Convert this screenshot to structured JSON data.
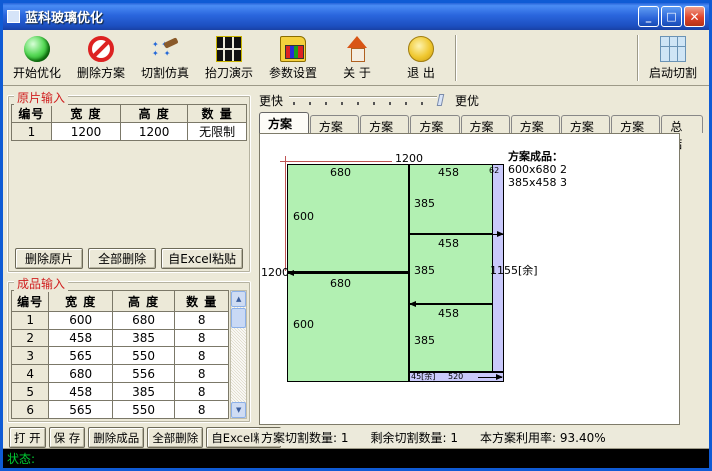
{
  "window": {
    "title": "蓝科玻璃优化",
    "minimize": "_",
    "maximize": "□",
    "close": "✕"
  },
  "toolbar": {
    "buttons": [
      {
        "label": "开始优化",
        "icon": "optimize"
      },
      {
        "label": "删除方案",
        "icon": "delete-plan"
      },
      {
        "label": "切割仿真",
        "icon": "simulate"
      },
      {
        "label": "抬刀演示",
        "icon": "knife-demo"
      },
      {
        "label": "参数设置",
        "icon": "settings"
      },
      {
        "label": "关 于",
        "icon": "about"
      },
      {
        "label": "退 出",
        "icon": "exit"
      }
    ],
    "start_cut": {
      "label": "启动切割",
      "icon": "start-cut"
    }
  },
  "sheet_input": {
    "title": "原片输入",
    "headers": [
      "编号",
      "宽 度",
      "高 度",
      "数 量"
    ],
    "rows": [
      [
        "1",
        "1200",
        "1200",
        "无限制"
      ]
    ],
    "buttons": [
      "删除原片",
      "全部删除",
      "自Excel粘贴"
    ]
  },
  "product_input": {
    "title": "成品输入",
    "headers": [
      "编号",
      "宽 度",
      "高 度",
      "数 量"
    ],
    "rows": [
      [
        "1",
        "600",
        "680",
        "8"
      ],
      [
        "2",
        "458",
        "385",
        "8"
      ],
      [
        "3",
        "565",
        "550",
        "8"
      ],
      [
        "4",
        "680",
        "556",
        "8"
      ],
      [
        "5",
        "458",
        "385",
        "8"
      ],
      [
        "6",
        "565",
        "550",
        "8"
      ]
    ],
    "buttons": [
      "打 开",
      "保 存",
      "删除成品",
      "全部删除",
      "自Excel粘贴"
    ]
  },
  "speed_slider": {
    "left_label": "更快",
    "right_label": "更优"
  },
  "tabs": [
    "方案1",
    "方案2",
    "方案3",
    "方案4",
    "方案5",
    "方案6",
    "方案7",
    "方案8",
    "总结"
  ],
  "active_tab_index": 0,
  "diagram": {
    "sheet_width": 1200,
    "sheet_height": 1200,
    "colors": {
      "piece": "#b2f0b2",
      "remainder": "#c9c9fb",
      "dimension_line": "#c05555"
    },
    "pieces": [
      {
        "x": 27,
        "y": 30,
        "w": 122,
        "h": 108,
        "c": "green"
      },
      {
        "x": 27,
        "y": 138,
        "w": 122,
        "h": 110,
        "c": "green"
      },
      {
        "x": 149,
        "y": 30,
        "w": 84,
        "h": 70,
        "c": "green"
      },
      {
        "x": 149,
        "y": 100,
        "w": 84,
        "h": 70,
        "c": "green"
      },
      {
        "x": 149,
        "y": 170,
        "w": 84,
        "h": 68,
        "c": "green"
      },
      {
        "x": 232,
        "y": 30,
        "w": 12,
        "h": 208,
        "c": "purple"
      },
      {
        "x": 149,
        "y": 238,
        "w": 95,
        "h": 10,
        "c": "purple"
      }
    ],
    "red_lines": [
      {
        "x": 30,
        "y": 27,
        "len": 102,
        "o": "h"
      },
      {
        "x": 25,
        "y": 33,
        "len": 104,
        "o": "v"
      }
    ],
    "origin": {
      "x": 20,
      "y": 22
    },
    "arrows": [
      {
        "x1": 150,
        "y": 100,
        "x2": 243,
        "dir": "right"
      },
      {
        "x1": 28,
        "y": 139,
        "x2": 149,
        "dir": "left"
      },
      {
        "x1": 150,
        "y": 170,
        "x2": 232,
        "dir": "left"
      },
      {
        "x1": 218,
        "y": 243,
        "x2": 242,
        "dir": "right"
      }
    ],
    "labels": [
      {
        "t": "1200",
        "x": 135,
        "y": 19
      },
      {
        "t": "680",
        "x": 70,
        "y": 33
      },
      {
        "t": "458",
        "x": 178,
        "y": 33
      },
      {
        "t": "62",
        "x": 229,
        "y": 33,
        "s": 1
      },
      {
        "t": "385",
        "x": 154,
        "y": 64
      },
      {
        "t": "600",
        "x": 33,
        "y": 77
      },
      {
        "t": "458",
        "x": 178,
        "y": 104
      },
      {
        "t": "1200",
        "x": 1,
        "y": 133
      },
      {
        "t": "680",
        "x": 70,
        "y": 144
      },
      {
        "t": "385",
        "x": 154,
        "y": 131
      },
      {
        "t": "1155[余]",
        "x": 230,
        "y": 131
      },
      {
        "t": "458",
        "x": 178,
        "y": 174
      },
      {
        "t": "600",
        "x": 33,
        "y": 185
      },
      {
        "t": "385",
        "x": 154,
        "y": 201
      },
      {
        "t": "45[余]",
        "x": 151,
        "y": 239,
        "s": 1
      },
      {
        "t": "520",
        "x": 188,
        "y": 239,
        "s": 1
      }
    ],
    "legend": {
      "title": "方案成品：",
      "items": [
        "600x680 2",
        "385x458 3"
      ],
      "x": 248,
      "y": 16
    }
  },
  "info_bar": {
    "plan_cut": "方案切割数量: 1",
    "remain_cut": "剩余切割数量: 1",
    "utilization": "本方案利用率: 93.40%"
  },
  "status_bar": {
    "label": "状态:"
  },
  "scrollbar": {
    "up": "▲",
    "down": "▼"
  }
}
